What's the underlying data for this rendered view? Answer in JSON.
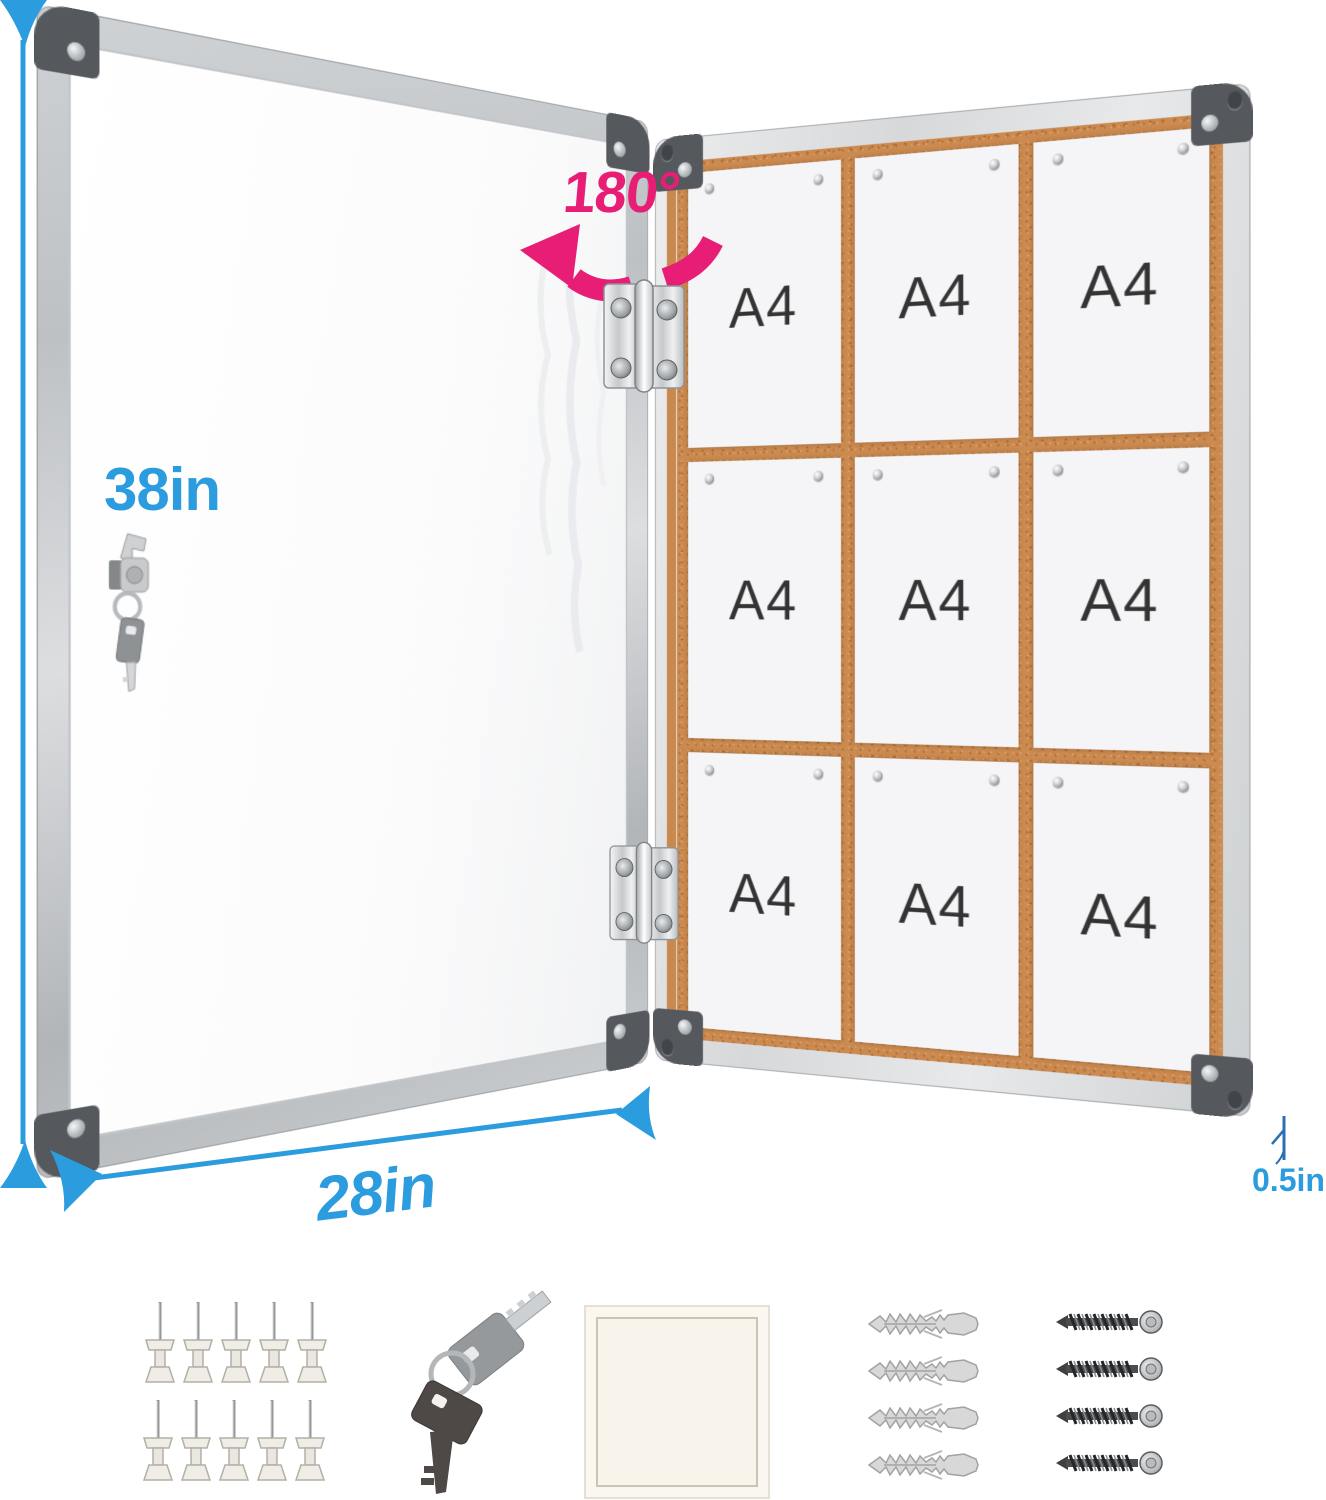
{
  "labels": {
    "height": "38in",
    "width": "28in",
    "depth": "0.5in",
    "door_rotation": "180°",
    "paper": "A4"
  },
  "board": {
    "paper_grid": "3x3",
    "paper_count": 9,
    "pins_per_paper": 2
  },
  "accessories": {
    "push_pins": {
      "icon": "push-pins-icon",
      "count": 10
    },
    "keys": {
      "icon": "keys-icon",
      "count": 2
    },
    "note_pad": {
      "icon": "note-pad-icon",
      "count": 1
    },
    "wall_anchors": {
      "icon": "wall-anchors-icon",
      "count": 4
    },
    "screws": {
      "icon": "screws-icon",
      "count": 4
    }
  },
  "hardware_icons": [
    "hinge-icon",
    "lock-icon",
    "corner-cap",
    "glass-reflection"
  ],
  "colors": {
    "dimension_blue": "#2B9CDE",
    "rotation_pink": "#E71D76",
    "cork": "#CA8A50",
    "frame_silver": "#D7D9DB",
    "corner_cap_gray": "#55595D",
    "paper_white": "#F5F5F7",
    "a4_text": "#333333"
  }
}
